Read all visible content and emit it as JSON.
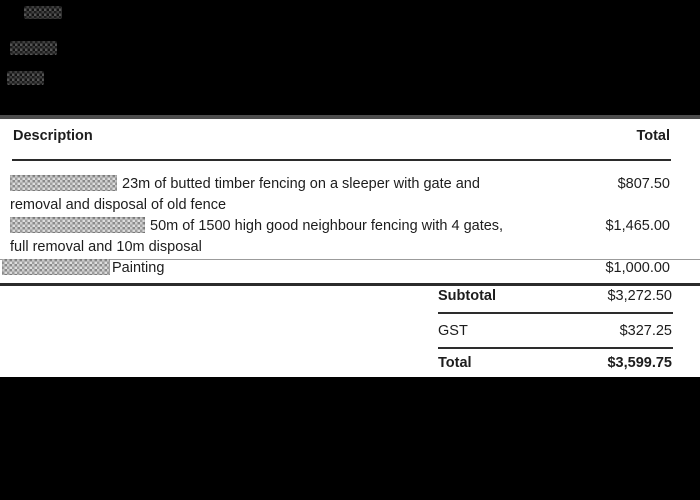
{
  "colors": {
    "page_background": "#000000",
    "document_background": "#ffffff",
    "text": "#1d1d1d",
    "rule_dark": "#2b2b2b",
    "rule_light": "#9b9b9b"
  },
  "invoice": {
    "columns": {
      "description": "Description",
      "total": "Total"
    },
    "items": [
      {
        "redacted_prefix": true,
        "lines": [
          "23m of butted timber fencing on a sleeper with gate and",
          "removal and disposal of old fence"
        ],
        "total": "$807.50"
      },
      {
        "redacted_prefix": true,
        "lines": [
          "50m of 1500 high good neighbour fencing with 4 gates,",
          "full removal and 10m disposal"
        ],
        "total": "$1,465.00"
      },
      {
        "redacted_prefix": true,
        "lines": [
          "Painting"
        ],
        "total": "$1,000.00"
      }
    ],
    "summary": {
      "subtotal": {
        "label": "Subtotal",
        "value": "$3,272.50"
      },
      "gst": {
        "label": "GST",
        "value": "$327.25"
      },
      "total": {
        "label": "Total",
        "value": "$3,599.75"
      }
    }
  }
}
